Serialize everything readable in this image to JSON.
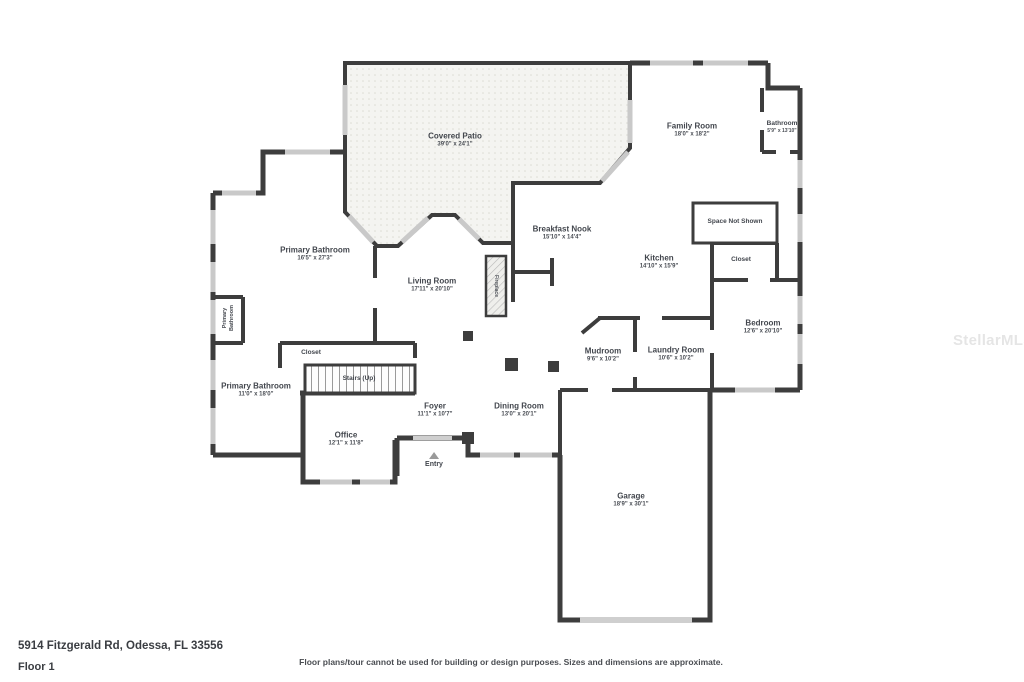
{
  "floorplan": {
    "watermark": "StellarMLS",
    "colors": {
      "wall": "#3d3d3d",
      "window": "#c9c9c9",
      "label_text": "#42464d",
      "patio_fill": "#f4f4f1"
    },
    "rooms": {
      "covered_patio": {
        "name": "Covered Patio",
        "dims": "39'0\" x 24'1\""
      },
      "family_room": {
        "name": "Family Room",
        "dims": "18'0\" x 18'2\""
      },
      "bathroom": {
        "name": "Bathroom",
        "dims": "5'9\" x 13'10\""
      },
      "breakfast_nook": {
        "name": "Breakfast Nook",
        "dims": "15'10\" x 14'4\""
      },
      "kitchen": {
        "name": "Kitchen",
        "dims": "14'10\" x 15'9\""
      },
      "space_not_shown": {
        "name": "Space Not Shown"
      },
      "closet_right": {
        "name": "Closet"
      },
      "primary_bathroom_large": {
        "name": "Primary Bathroom",
        "dims": "16'5\" x 27'3\""
      },
      "living_room": {
        "name": "Living Room",
        "dims": "17'11\" x 20'10\""
      },
      "fireplace": {
        "name": "Fireplace"
      },
      "primary_bathroom_small": {
        "name": "Primary Bathroom"
      },
      "bedroom": {
        "name": "Bedroom",
        "dims": "12'6\" x 20'10\""
      },
      "mudroom": {
        "name": "Mudroom",
        "dims": "9'6\" x 10'2\""
      },
      "laundry_room": {
        "name": "Laundry Room",
        "dims": "10'6\" x 10'2\""
      },
      "closet_left": {
        "name": "Closet"
      },
      "stairs": {
        "name": "Stairs (Up)"
      },
      "primary_bathroom_lower": {
        "name": "Primary Bathroom",
        "dims": "11'0\" x 18'0\""
      },
      "foyer": {
        "name": "Foyer",
        "dims": "11'1\" x 10'7\""
      },
      "dining_room": {
        "name": "Dining Room",
        "dims": "13'0\" x 20'1\""
      },
      "office": {
        "name": "Office",
        "dims": "12'1\" x 11'8\""
      },
      "entry": {
        "name": "Entry"
      },
      "garage": {
        "name": "Garage",
        "dims": "18'9\" x 30'1\""
      }
    }
  },
  "footer": {
    "address": "5914 Fitzgerald Rd, Odessa, FL 33556",
    "floor_label": "Floor 1",
    "disclaimer": "Floor plans/tour cannot be used for building or design purposes. Sizes and dimensions are approximate."
  }
}
